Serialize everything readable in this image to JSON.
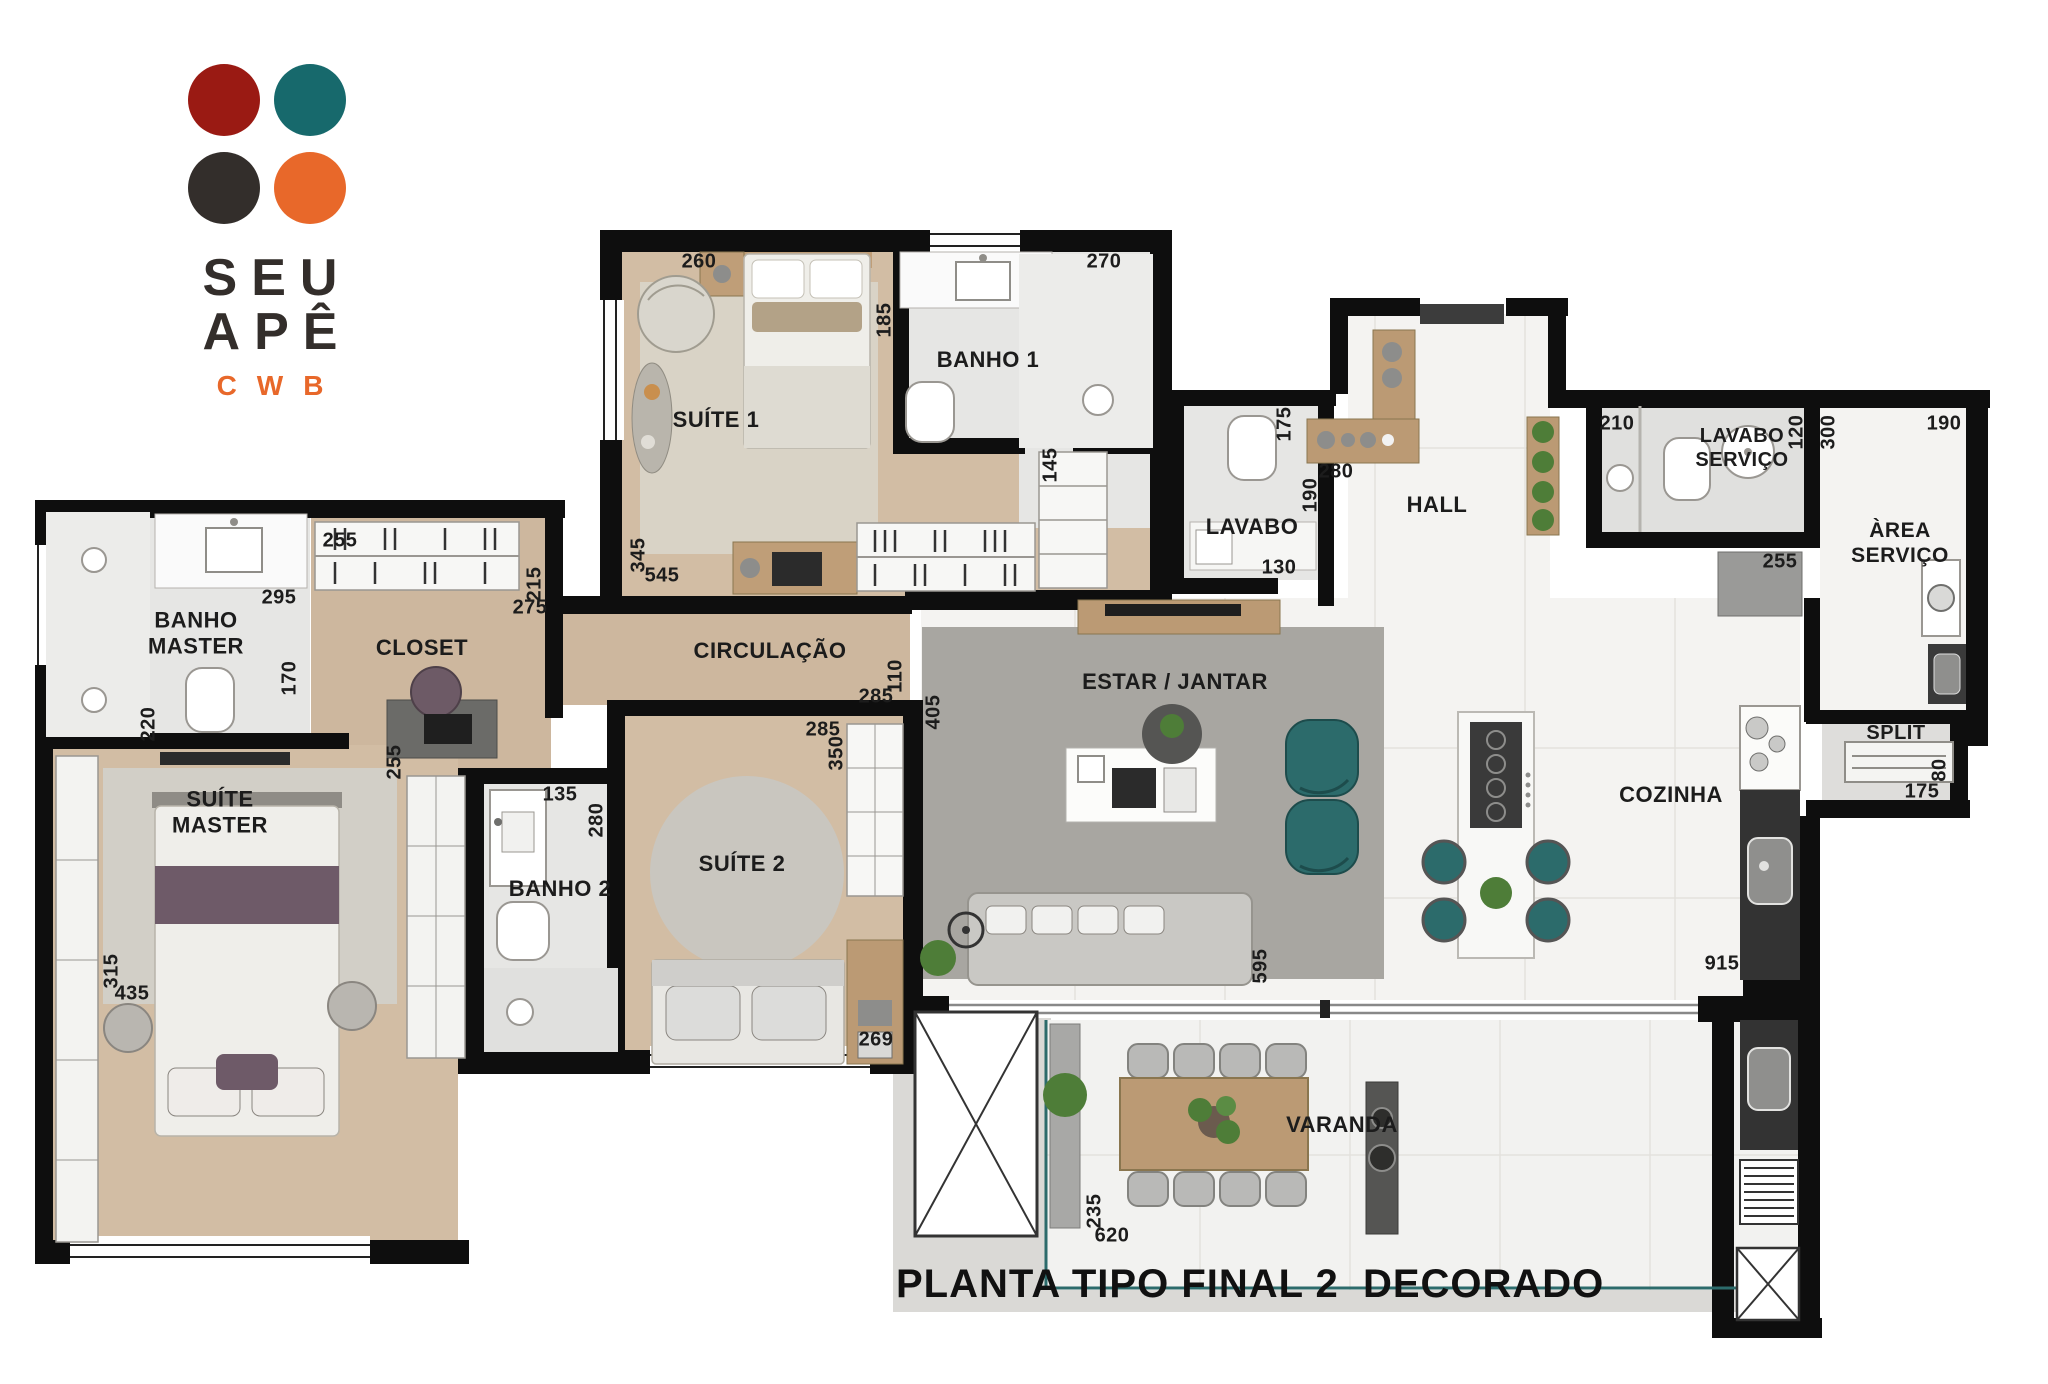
{
  "logo": {
    "line1": "SEU",
    "line2": "APÊ",
    "line3": "CWB"
  },
  "title": "PLANTA TIPO FINAL 2  DECORADO",
  "rooms": {
    "suite1": "SUÍTE 1",
    "banho1": "BANHO 1",
    "lavabo": "LAVABO",
    "hall": "HALL",
    "lavabo_servico_l1": "LAVABO",
    "lavabo_servico_l2": "SERVIÇO",
    "area_servico_l1": "ÀREA",
    "area_servico_l2": "SERVIÇO",
    "banho_master_l1": "BANHO",
    "banho_master_l2": "MASTER",
    "closet": "CLOSET",
    "circulacao": "CIRCULAÇÃO",
    "suite_master_l1": "SUÍTE",
    "suite_master_l2": "MASTER",
    "banho2": "BANHO 2",
    "suite2": "SUÍTE 2",
    "estar_jantar": "ESTAR / JANTAR",
    "cozinha": "COZINHA",
    "split": "SPLIT",
    "varanda": "VARANDA"
  },
  "dims": {
    "suite1_top": "260",
    "suite1_left": "345",
    "suite1_bottom": "545",
    "banho1_top": "270",
    "banho1_left": "185",
    "wardrobe_side": "145",
    "lavabo_right": "175",
    "lavabo_bottom": "130",
    "hall_shelf": "280",
    "hall_left": "190",
    "lavabo_servico_top": "210",
    "lavabo_servico_right": "120",
    "area_servico_left": "300",
    "area_servico_top": "190",
    "area_servico_cabinet": "255",
    "banho_master_width": "295",
    "banho_master_door": "170",
    "banho_master_left": "220",
    "closet_top": "255",
    "closet_right_v": "215",
    "closet_right_h": "275",
    "closet_bottom": "255",
    "banho2_top": "135",
    "banho2_right": "280",
    "circulacao_right": "110",
    "circulacao_bottom": "285",
    "suite2_top": "285",
    "suite2_right": "350",
    "suite2_bottom": "269",
    "suite_master_left": "315",
    "suite_master_bottom": "435",
    "estar_left": "405",
    "estar_right": "595",
    "cozinha_bottom": "915",
    "split_right": "80",
    "split_bottom": "175",
    "varanda_left": "235",
    "varanda_bottom": "620"
  },
  "colors": {
    "brand_red": "#9a1a13",
    "brand_teal": "#17696c",
    "brand_dark": "#332e2b",
    "brand_orange": "#e8682a",
    "wall": "#0e0e0e",
    "wood_floor": "#d2bda4",
    "bath_floor": "#e6e6e4",
    "tile_floor": "#f4f3f1",
    "rug": "#a8a6a1",
    "accent_teal": "#2c6b6b",
    "accent_purple": "#6e5a68",
    "granite": "#333333",
    "furniture_wood": "#bf9e78"
  }
}
